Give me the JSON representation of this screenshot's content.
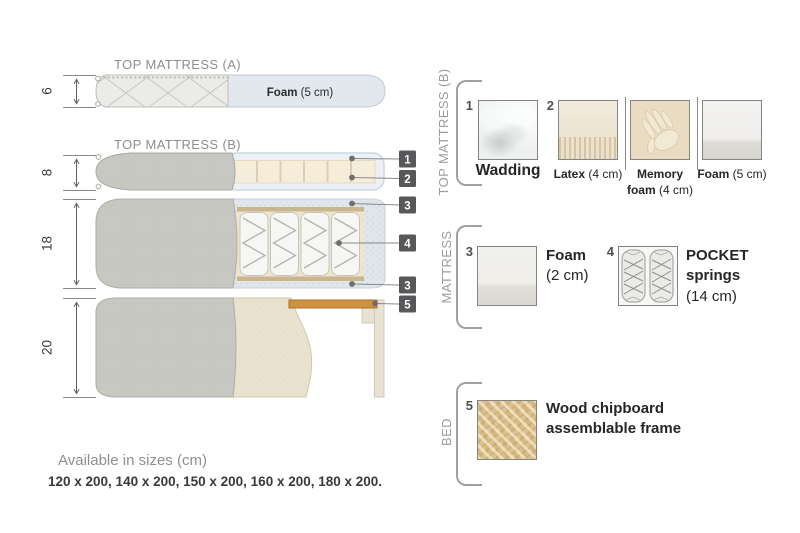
{
  "diagram": {
    "title_a": "TOP MATTRESS (A)",
    "title_b": "TOP MATTRESS (B)",
    "dim_a": "6",
    "dim_b": "8",
    "dim_mattress": "18",
    "dim_bed": "20",
    "foam_a_bold": "Foam",
    "foam_a_rest": " (5 cm)",
    "callouts": [
      "1",
      "2",
      "3",
      "4",
      "3",
      "5"
    ]
  },
  "legend": {
    "top_mattress_b": {
      "label": "TOP MATTRESS (B)",
      "items": {
        "wadding": {
          "num": "1",
          "caption": "Wadding"
        },
        "latex": {
          "num": "2",
          "bold": "Latex",
          "rest": " (4 cm)"
        },
        "memory_foam": {
          "bold1": "Memory",
          "bold2": "foam",
          "rest": " (4 cm)"
        },
        "foam": {
          "bold": "Foam",
          "rest": " (5 cm)"
        }
      }
    },
    "mattress": {
      "label": "MATTRESS",
      "items": {
        "foam": {
          "num": "3",
          "bold": "Foam",
          "rest": "(2 cm)"
        },
        "pocket_springs": {
          "num": "4",
          "bold1": "POCKET",
          "bold2": "springs",
          "rest": "(14 cm)"
        }
      }
    },
    "bed": {
      "label": "BED",
      "items": {
        "frame": {
          "num": "5",
          "line1": "Wood chipboard",
          "line2": "assemblable frame"
        }
      }
    }
  },
  "footer": {
    "sizes_title": "Available in sizes (cm)",
    "sizes_list": "120 x 200, 140 x 200, 150 x 200, 160 x 200, 180 x 200."
  },
  "colors": {
    "badge": "#58585a",
    "wood": "#cf9340",
    "fabric_gray": "#c8c8c3",
    "latex_cream": "#f5ecda",
    "foam_blue": "#e3e7ee"
  }
}
